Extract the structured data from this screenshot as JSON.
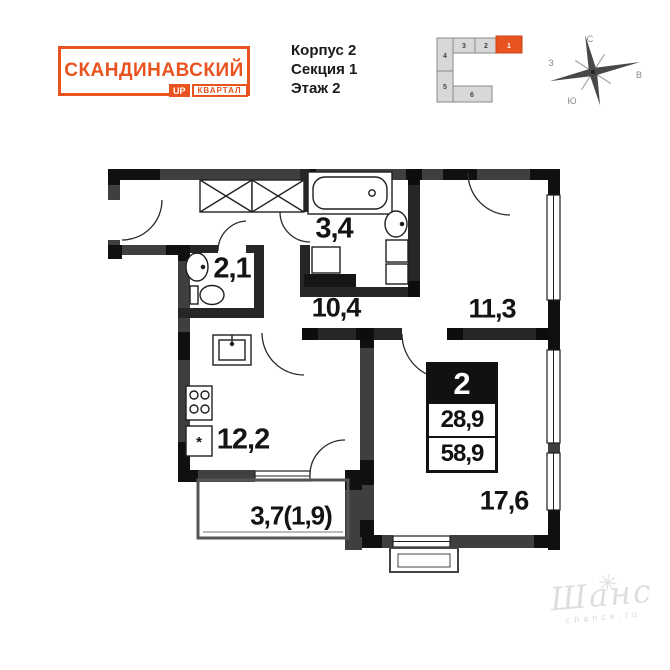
{
  "header": {
    "logo": {
      "title": "СКАНДИНАВСКИЙ",
      "badge_up": "UP",
      "badge_kvartal": "КВАРТАЛ"
    },
    "building_info": {
      "korpus": "Корпус 2",
      "sektsiya": "Секция 1",
      "etazh": "Этаж 2"
    },
    "locator": {
      "block_numbers": [
        "3",
        "2",
        "1",
        "4",
        "5",
        "6"
      ],
      "highlighted_block": "1"
    },
    "compass": {
      "north": "С",
      "east": "В",
      "south": "Ю",
      "west": "З"
    }
  },
  "floor_plan": {
    "rooms": [
      {
        "name": "bathroom-small",
        "area": "2,1"
      },
      {
        "name": "bathroom",
        "area": "3,4"
      },
      {
        "name": "hallway",
        "area": "10,4"
      },
      {
        "name": "bedroom",
        "area": "11,3"
      },
      {
        "name": "kitchen",
        "area": "12,2"
      },
      {
        "name": "living-room",
        "area": "17,6"
      },
      {
        "name": "balcony",
        "area": "3,7(1,9)"
      }
    ],
    "info_box": {
      "rooms_count": "2",
      "living_area": "28,9",
      "total_area": "58,9"
    },
    "fridge_symbol": "*"
  },
  "watermark": {
    "script": "Шанс",
    "caption": "chance.ru",
    "star": "✳"
  },
  "colors": {
    "accent": "#E8531F",
    "wall": "#3f3f3f",
    "wall_dark": "#101010"
  }
}
